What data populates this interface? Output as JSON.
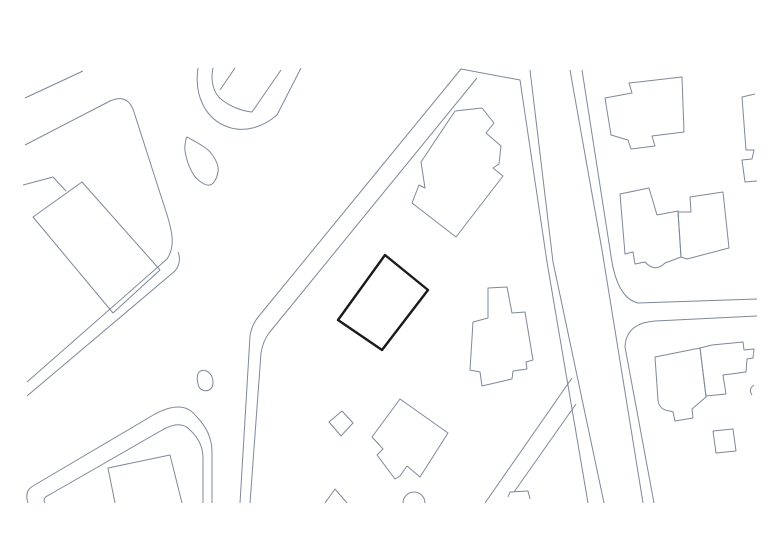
{
  "canvas": {
    "width": 780,
    "height": 551,
    "background": "#ffffff"
  },
  "plan": {
    "description": "site-plan-line-drawing",
    "clip": {
      "x": 23,
      "y": 67,
      "width": 734,
      "height": 436
    },
    "line_color": "#7e8898",
    "line_width": 1,
    "highlight_color": "#1a1a1a",
    "highlight_width": 2.4,
    "roads": [
      {
        "id": "road-top-left-upper-edge",
        "d": "M 25,98 L 83,71"
      },
      {
        "id": "road-west-curve-outer-edge",
        "d": "M 25,145 L 110,101 Q 128,93 134,112 L 159,190 C 170,224 178,243 167,259 L 27,382"
      },
      {
        "id": "road-west-curve-inner-edge",
        "d": "M 178,252 Q 182,262 175,271 L 27,396"
      },
      {
        "id": "road-hairpin-outer-edge",
        "d": "M 28,503 Q 24,491 33,486 L 155,414 Q 183,399 196,416 Q 212,432 212,452 L 212,503"
      },
      {
        "id": "road-hairpin-inner-edge",
        "d": "M 45,503 Q 42,498 49,495 L 164,429 Q 181,420 190,430 Q 203,442 203,458 L 203,503"
      },
      {
        "id": "road-main-west-edge",
        "d": "M 240,503 L 250,336 Q 252,324 259,316 L 461,69 L 520,80 L 547,262 L 588,503"
      },
      {
        "id": "road-main-east-edge",
        "d": "M 250,503 L 261,353 Q 263,341 269,333 L 477,78"
      },
      {
        "id": "road-north-inner-west-edge",
        "d": "M 530,70 L 553,262 L 604,503"
      },
      {
        "id": "road-north-east-pair-left",
        "d": "M 570,70 L 602,250 L 643,503"
      },
      {
        "id": "road-north-east-pair-right-and-east-branch-upper",
        "d": "M 582,70 L 611,256 Q 617,298 638,303 L 757,299"
      },
      {
        "id": "road-east-branch-lower-edge",
        "d": "M 757,316 L 655,321 Q 626,323 625,347 L 654,503"
      },
      {
        "id": "road-southwest-branch-upper-edge",
        "d": "M 572,378 L 485,503"
      },
      {
        "id": "road-southwest-branch-lower-edge",
        "d": "M 576,404 L 514,492"
      },
      {
        "id": "road-loop-outer-edge",
        "d": "M 198,68 C 194,95 205,119 228,127 C 245,133 263,127 277,115 L 301,68"
      },
      {
        "id": "road-loop-inner-edge",
        "d": "M 213,68 C 210,82 214,94 222,100 C 230,106 241,111 252,112 L 281,70"
      },
      {
        "id": "road-loop-spur-line",
        "d": "M 235,68 L 220,90"
      }
    ],
    "water": [
      {
        "id": "pond-leaf-shape",
        "d": "M 187,137 C 196,142 206,147 211,153 C 217,161 219,167 218,172 C 217,178 214,184 210,185 C 205,186 196,180 192,172 C 187,163 184,150 185,145 C 186,140 186,137 187,137 Z"
      },
      {
        "id": "pond-small-blob",
        "d": "M 199,372 C 204,368 210,372 212,377 C 214,382 213,388 209,390 C 205,392 199,390 198,384 C 197,380 197,375 199,372 Z"
      }
    ],
    "buildings": [
      {
        "id": "building-west-large",
        "d": "M 82,182 L 160,270 L 113,313 L 33,217 Z"
      },
      {
        "id": "building-west-overlap-line",
        "d": "M 23,185 L 53,177 L 66,191"
      },
      {
        "id": "building-top-center-jagged",
        "d": "M 455,111 L 482,108 L 494,123 L 486,133 L 501,146 L 499,164 L 493,168 L 503,176 L 456,237 L 412,203 L 419,185 L 425,188 L 421,162 Z"
      },
      {
        "id": "building-top-right",
        "d": "M 629,83 L 682,77 L 684,132 L 652,136 L 655,146 L 631,149 L 628,140 L 611,135 L 605,98 L 632,93 Z"
      },
      {
        "id": "building-right-edge-clipped",
        "d": "M 755,94 L 742,97 L 746,150 L 754,150 L 752,159 L 742,160 L 745,182 L 757,181"
      },
      {
        "id": "building-mid-right-west",
        "d": "M 620,194 L 649,188 L 657,215 L 678,211 L 681,257 L 665,263 Q 655,273 645,262 L 635,264 L 633,252 L 625,254 Z"
      },
      {
        "id": "building-mid-right-east",
        "d": "M 690,197 L 723,192 L 729,248 L 687,259 L 681,257 L 678,212 L 691,212 Z"
      },
      {
        "id": "building-southeast-complex-west",
        "d": "M 700,348 L 655,357 L 658,400 Q 659,410 670,411 L 673,412 L 675,421 L 693,418 L 692,409 L 706,397 Z"
      },
      {
        "id": "building-southeast-complex-east",
        "d": "M 700,348 L 712,345 L 743,342 L 744,350 L 754,349 L 753,358 L 747,359 L 746,372 L 723,375 L 726,394 L 706,396 Z"
      },
      {
        "id": "building-southeast-square",
        "d": "M 713,431 L 733,429 L 736,451 L 716,453 Z"
      },
      {
        "id": "building-southeast-hook",
        "d": "M 754,385 Q 748,389 752,395"
      },
      {
        "id": "building-center-cross-shaped",
        "d": "M 488,288 L 507,287 L 512,313 L 525,312 L 533,360 L 526,362 L 527,369 L 513,371 L 512,379 L 482,386 L 480,372 L 470,370 L 473,322 L 488,318 Z"
      },
      {
        "id": "building-south-house-notched",
        "d": "M 400,399 L 448,433 L 420,477 L 407,466 L 400,476 L 395,479 L 377,455 L 383,449 L 372,437 Z"
      },
      {
        "id": "building-south-shed",
        "d": "M 329,422 L 342,411 L 353,423 L 341,436 Z"
      },
      {
        "id": "building-south-circle-clipped",
        "d": "M 403,503 A 11 11 0 1 1 425,503"
      },
      {
        "id": "building-south-peak-clipped",
        "d": "M 325,503 L 335,489 L 347,503"
      },
      {
        "id": "building-southwest-clipped",
        "d": "M 115,503 L 108,468 L 170,455 L 182,503"
      },
      {
        "id": "building-branch-end-clipped",
        "d": "M 508,497 L 510,492 L 528,491 L 530,499"
      }
    ],
    "highlight": {
      "id": "highlighted-site-rectangle",
      "d": "M 385,255 L 428,290 L 382,350 L 338,320 Z"
    }
  }
}
